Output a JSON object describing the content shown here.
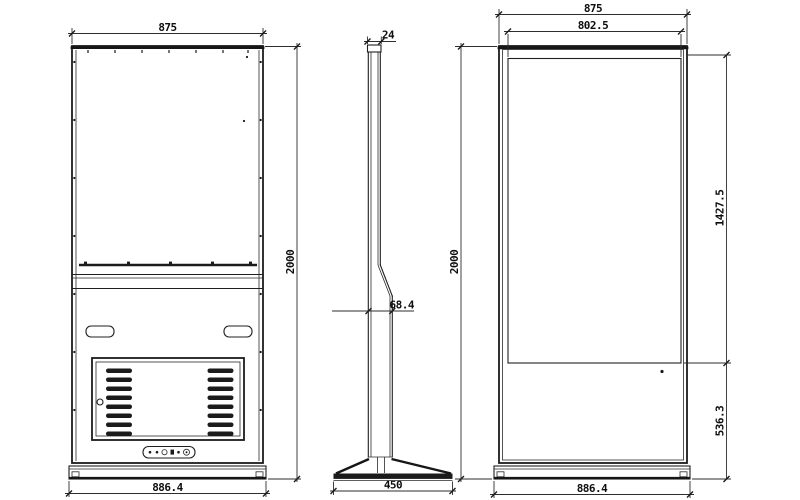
{
  "colors": {
    "line": "#1f1f1f",
    "background": "#ffffff",
    "louver_fill": "#1b1b1b"
  },
  "views": {
    "back": {
      "dims": {
        "top_width": "875",
        "height": "2000",
        "base_width": "886.4"
      }
    },
    "side": {
      "dims": {
        "top_depth": "24",
        "mid_depth": "68.4",
        "base_depth": "450"
      }
    },
    "front": {
      "dims": {
        "top_width": "875",
        "screen_width": "802.5",
        "height": "2000",
        "screen_height": "1427.5",
        "lower_height": "536.3",
        "base_width": "886.4"
      }
    }
  }
}
